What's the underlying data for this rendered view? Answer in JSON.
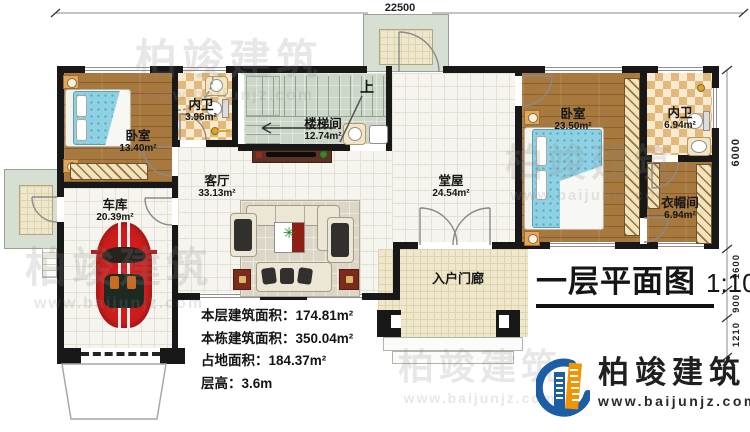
{
  "title": {
    "text": "一层平面图",
    "scale": "1:100"
  },
  "dimensions": {
    "top": "22500",
    "right": "6000",
    "right_segments": [
      "1600",
      "900",
      "1210"
    ]
  },
  "annotations": {
    "up": "上"
  },
  "rooms": {
    "bedroom1": {
      "name": "卧室",
      "area": "13.40m²"
    },
    "bath1": {
      "name": "内卫",
      "area": "3.96m²"
    },
    "stairwell": {
      "name": "楼梯间",
      "area": "12.74m²"
    },
    "living": {
      "name": "客厅",
      "area": "33.13m²"
    },
    "garage": {
      "name": "车库",
      "area": "20.39m²"
    },
    "hall": {
      "name": "堂屋",
      "area": "24.54m²"
    },
    "bedroom2": {
      "name": "卧室",
      "area": "23.50m²"
    },
    "bath2": {
      "name": "内卫",
      "area": "6.94m²"
    },
    "cloakroom": {
      "name": "衣帽间",
      "area": "6.94m²"
    },
    "porch": {
      "name": "入户门廊"
    }
  },
  "stats": [
    {
      "label": "本层建筑面积：",
      "value": "174.81m²"
    },
    {
      "label": "本栋建筑面积：",
      "value": "350.04m²"
    },
    {
      "label": "占地面积：",
      "value": "184.37m²"
    },
    {
      "label": "层高：",
      "value": "3.6m"
    }
  ],
  "branding": {
    "company": "柏竣建筑",
    "website": "www.baijunjz.com"
  },
  "colors": {
    "accent_blue": "#1b5ea6",
    "accent_orange": "#f29400",
    "wall": "#181818"
  }
}
